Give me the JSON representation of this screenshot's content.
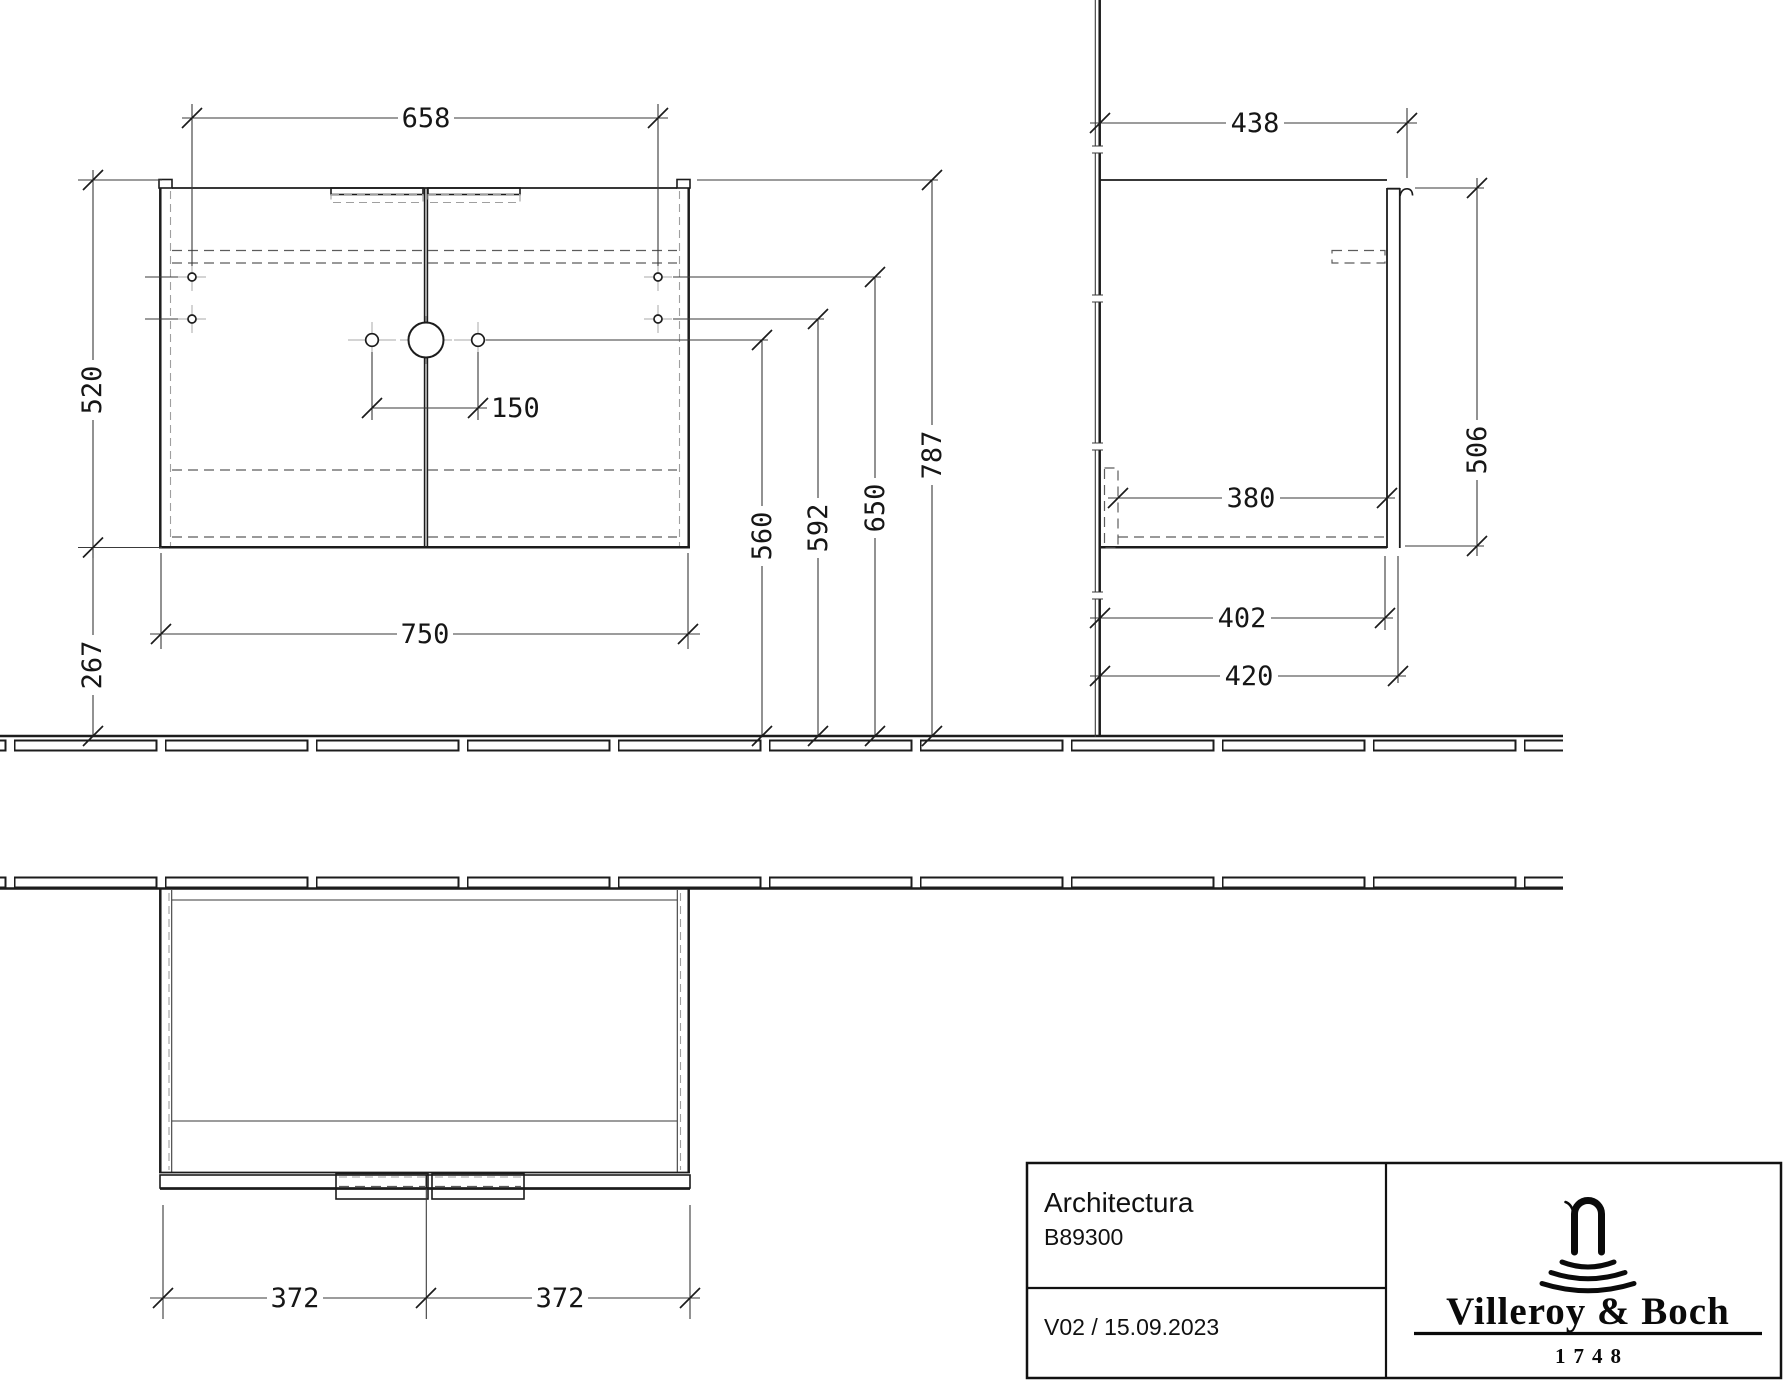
{
  "drawing": {
    "front_view": {
      "width_between_wall_holes": "658",
      "cabinet_height": "520",
      "height_below_cabinet": "267",
      "cabinet_width": "750",
      "tap_hole_spacing": "150",
      "tap_hole_height": "560",
      "lower_hole_height": "592",
      "upper_hole_height": "650",
      "top_edge_height": "787"
    },
    "side_view": {
      "total_depth": "438",
      "front_height": "506",
      "inner_shelf_depth": "380",
      "carcass_depth": "402",
      "depth_with_front": "420"
    },
    "top_view": {
      "left_door_width": "372",
      "right_door_width": "372"
    },
    "title_block": {
      "series_name": "Architectura",
      "article_number": "B89300",
      "version_and_date": "V02 / 15.09.2023",
      "brand_name": "Villeroy & Boch",
      "brand_founding_year": "1748"
    }
  }
}
